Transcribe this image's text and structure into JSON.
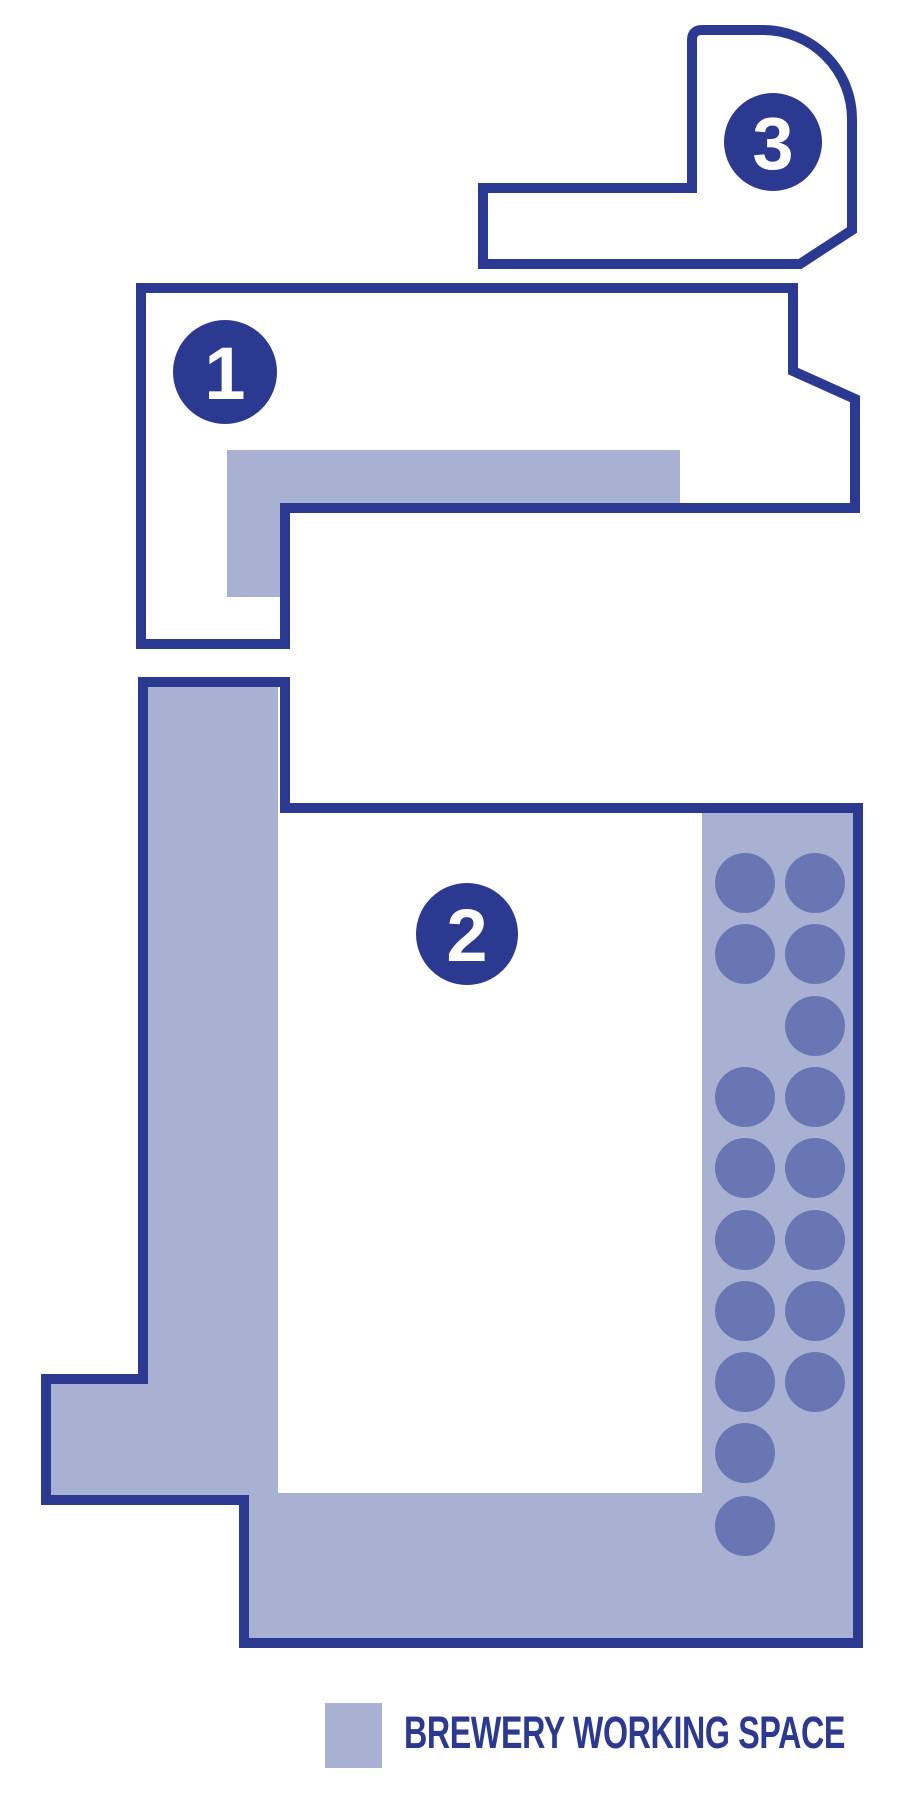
{
  "page": {
    "title": "Brewery floor plan"
  },
  "colors": {
    "outline": "#2b3990",
    "working_space": "#a9b1d3",
    "tank": "#6876b4",
    "numeral": "#ffffff",
    "background": "#ffffff"
  },
  "areas": [
    {
      "label": "1"
    },
    {
      "label": "2"
    },
    {
      "label": "3"
    }
  ],
  "tanks": {
    "count": 17
  },
  "legend": {
    "label": "BREWERY WORKING SPACE"
  }
}
